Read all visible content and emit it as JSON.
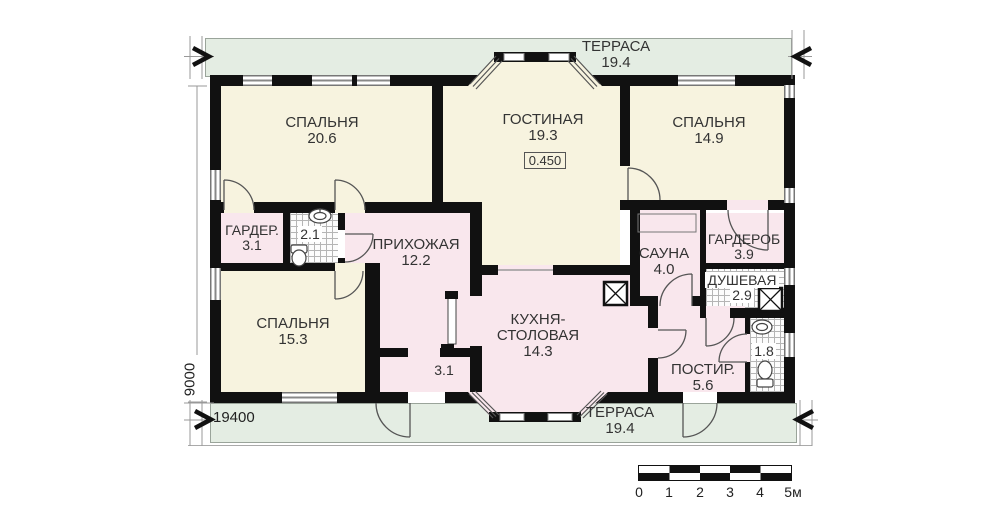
{
  "colors": {
    "cream": "#f7f3df",
    "pink": "#f9e7ed",
    "terrace_green": "#e4ede3",
    "wall": "#111111",
    "text": "#333333"
  },
  "plan": {
    "terrace_top": {
      "name": "ТЕРРАСА",
      "area": "19.4"
    },
    "terrace_bottom": {
      "name": "ТЕРРАСА",
      "area": "19.4"
    },
    "level_mark": "0.450",
    "dims": {
      "width": "19400",
      "height": "9000"
    },
    "rooms": {
      "bedroom1": {
        "name": "СПАЛЬНЯ",
        "area": "20.6"
      },
      "living": {
        "name": "ГОСТИНАЯ",
        "area": "19.3"
      },
      "bedroom2": {
        "name": "СПАЛЬНЯ",
        "area": "14.9"
      },
      "wardrobe1": {
        "name": "ГАРДЕР.",
        "area": "3.1"
      },
      "bath": {
        "area": "2.1"
      },
      "hall": {
        "name": "ПРИХОЖАЯ",
        "area": "12.2"
      },
      "bedroom3": {
        "name": "СПАЛЬНЯ",
        "area": "15.3"
      },
      "tambour": {
        "area": "3.1"
      },
      "kitchen": {
        "name_line1": "КУХНЯ-",
        "name_line2": "СТОЛОВАЯ",
        "area": "14.3"
      },
      "sauna": {
        "name": "САУНА",
        "area": "4.0"
      },
      "wardrobe2": {
        "name": "ГАРДЕРОБ",
        "area": "3.9"
      },
      "shower": {
        "name": "ДУШЕВАЯ",
        "area": "2.9"
      },
      "laundry": {
        "name": "ПОСТИР.",
        "area": "5.6"
      },
      "wc": {
        "area": "1.8"
      }
    },
    "scale_bar": {
      "labels": [
        "0",
        "1",
        "2",
        "3",
        "4",
        "5м"
      ]
    }
  }
}
